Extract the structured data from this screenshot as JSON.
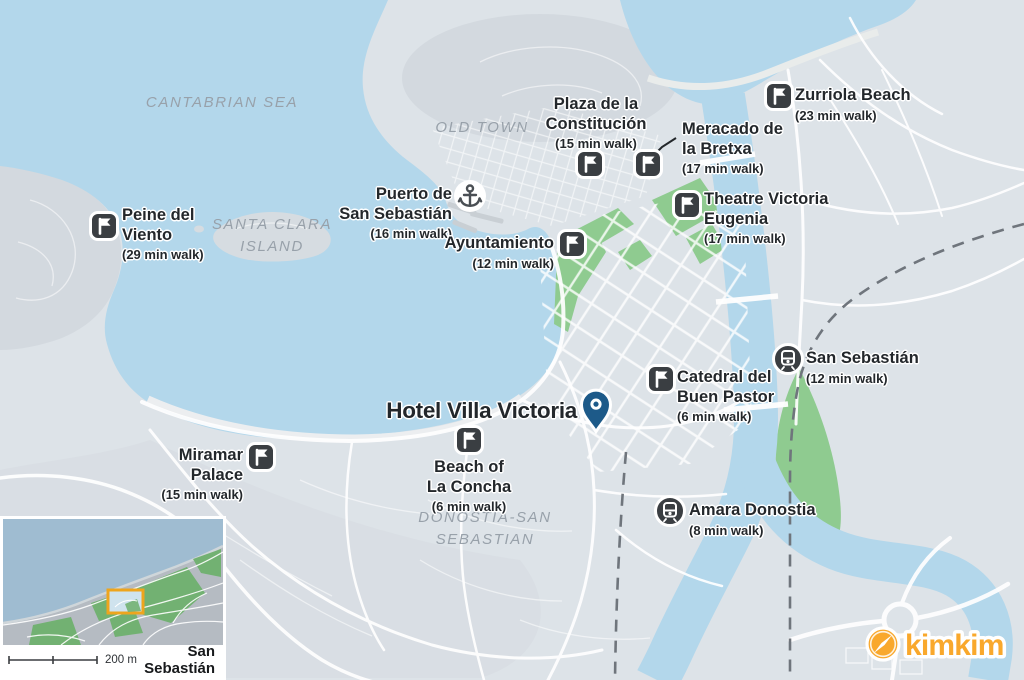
{
  "area_labels": [
    {
      "id": "cantabrian-sea",
      "lines": [
        "CANTABRIAN SEA"
      ],
      "x": 222,
      "y": 103
    },
    {
      "id": "old-town",
      "lines": [
        "OLD TOWN"
      ],
      "x": 482,
      "y": 128
    },
    {
      "id": "santa-clara-island",
      "lines": [
        "SANTA CLARA",
        "ISLAND"
      ],
      "x": 272,
      "y": 236
    },
    {
      "id": "donostia-san-sebastian",
      "lines": [
        "DONOSTIA-SAN",
        "SEBASTIAN"
      ],
      "x": 485,
      "y": 529
    }
  ],
  "pois": [
    {
      "id": "peine-del-viento",
      "name_lines": [
        "Peine del",
        "Viento"
      ],
      "walk_time": "(29 min walk)",
      "icon": "flag",
      "icon_x": 104,
      "icon_y": 226,
      "text_x": 122,
      "text_y": 206,
      "align": "left"
    },
    {
      "id": "puerto-de-san-sebastian",
      "name_lines": [
        "Puerto de",
        "San Sebastián"
      ],
      "walk_time": "(16 min walk)",
      "icon": "anchor",
      "icon_x": 470,
      "icon_y": 196,
      "text_x": 452,
      "text_y": 185,
      "align": "right"
    },
    {
      "id": "plaza-de-la-constitucion",
      "name_lines": [
        "Plaza de la",
        "Constitución"
      ],
      "walk_time": "(15 min walk)",
      "icon": "flag",
      "icon_x": 590,
      "icon_y": 164,
      "text_x": 596,
      "text_y": 95,
      "align": "center"
    },
    {
      "id": "meracado-de-la-bretxa",
      "name_lines": [
        "Meracado de",
        "la Bretxa"
      ],
      "walk_time": "(17 min walk)",
      "icon": "flag",
      "icon_x": 648,
      "icon_y": 164,
      "text_x": 682,
      "text_y": 120,
      "align": "left"
    },
    {
      "id": "zurriola-beach",
      "name_lines": [
        "Zurriola Beach"
      ],
      "walk_time": "(23 min walk)",
      "icon": "flag",
      "icon_x": 779,
      "icon_y": 96,
      "text_x": 795,
      "text_y": 86,
      "align": "left"
    },
    {
      "id": "theatre-victoria-eugenia",
      "name_lines": [
        "Theatre Victoria",
        "Eugenia"
      ],
      "walk_time": "(17 min walk)",
      "icon": "flag",
      "icon_x": 687,
      "icon_y": 205,
      "text_x": 704,
      "text_y": 190,
      "align": "left"
    },
    {
      "id": "ayuntamiento",
      "name_lines": [
        "Ayuntamiento"
      ],
      "walk_time": "(12 min walk)",
      "icon": "flag",
      "icon_x": 572,
      "icon_y": 244,
      "text_x": 554,
      "text_y": 234,
      "align": "right"
    },
    {
      "id": "catedral-del-buen-pastor",
      "name_lines": [
        "Catedral del",
        "Buen Pastor"
      ],
      "walk_time": "(6 min walk)",
      "icon": "flag",
      "icon_x": 661,
      "icon_y": 379,
      "text_x": 677,
      "text_y": 368,
      "align": "left"
    },
    {
      "id": "san-sebastian-station",
      "name_lines": [
        "San Sebastián"
      ],
      "walk_time": "(12 min walk)",
      "icon": "train",
      "icon_x": 788,
      "icon_y": 359,
      "text_x": 806,
      "text_y": 349,
      "align": "left"
    },
    {
      "id": "hotel-villa-victoria",
      "name_lines": [
        "Hotel Villa Victoria"
      ],
      "walk_time": "",
      "icon": "pin",
      "icon_x": 596,
      "icon_y": 414,
      "text_x": 577,
      "text_y": 398,
      "align": "right",
      "emphasis": true
    },
    {
      "id": "miramar-palace",
      "name_lines": [
        "Miramar",
        "Palace"
      ],
      "walk_time": "(15 min walk)",
      "icon": "flag",
      "icon_x": 261,
      "icon_y": 457,
      "text_x": 243,
      "text_y": 446,
      "align": "right"
    },
    {
      "id": "beach-of-la-concha",
      "name_lines": [
        "Beach of",
        "La Concha"
      ],
      "walk_time": "(6 min walk)",
      "icon": "flag",
      "icon_x": 469,
      "icon_y": 440,
      "text_x": 469,
      "text_y": 458,
      "align": "center"
    },
    {
      "id": "amara-donostia",
      "name_lines": [
        "Amara Donostia"
      ],
      "walk_time": "(8 min walk)",
      "icon": "train",
      "icon_x": 670,
      "icon_y": 511,
      "text_x": 689,
      "text_y": 501,
      "align": "left"
    }
  ],
  "inset": {
    "scale_label": "200 m",
    "city_label": "San Sebastián"
  },
  "logo": {
    "text": "kimkim"
  },
  "colors": {
    "sea": "#b3d7eb",
    "land": "#dde3e8",
    "park_green": "#8fcb90",
    "pin_blue": "#1d5a89",
    "marker_dark": "#3a3e42",
    "logo_orange": "#f9a82c"
  }
}
